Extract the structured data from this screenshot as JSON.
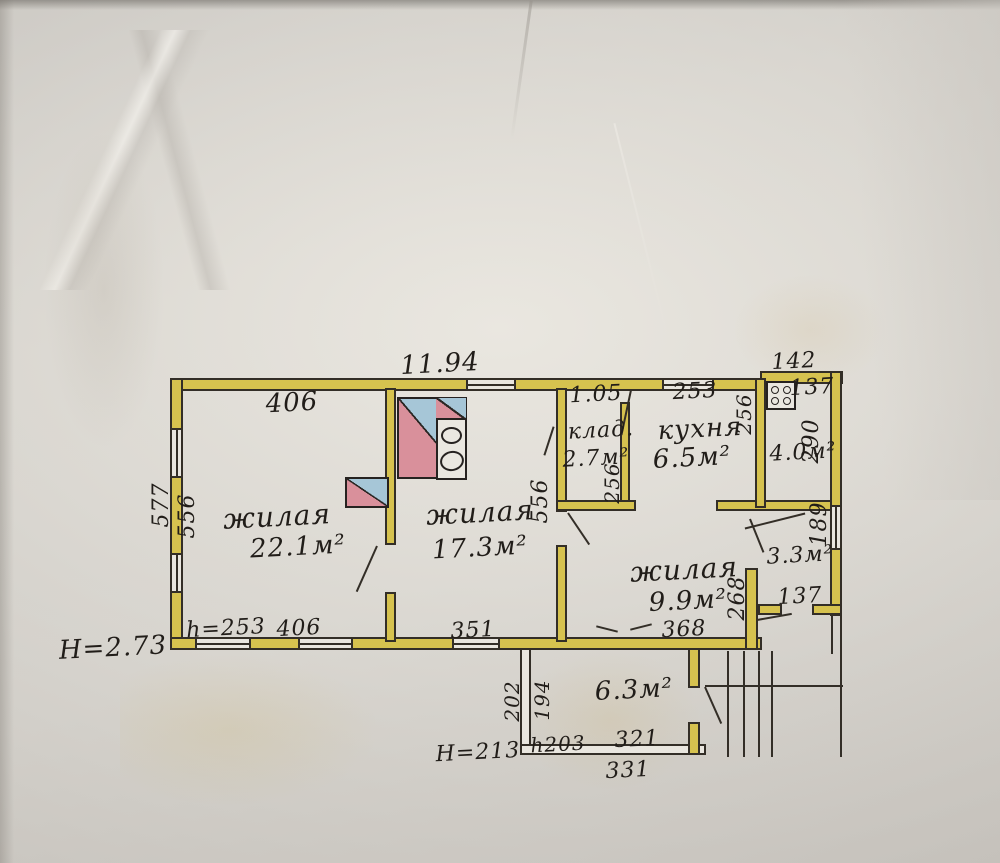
{
  "document": {
    "type": "hand-drawn floor plan (technical inventory plan)",
    "language": "Russian"
  },
  "colors": {
    "paper": "#d3cfca",
    "wall_fill": "#d6c24f",
    "ink": "#2b2724",
    "stove_blue": "#a6c6d7",
    "stove_red": "#d9909b"
  },
  "rooms": {
    "living1": {
      "name": "жилая",
      "area": "22.1м²"
    },
    "living2": {
      "name": "жилая",
      "area": "17.3м²"
    },
    "living3": {
      "name": "жилая",
      "area": "9.9м²"
    },
    "storage": {
      "name": "клад.",
      "area": "2.7м²"
    },
    "kitchen": {
      "name": "кухня",
      "area": "6.5м²"
    },
    "room40": {
      "area": "4.0м²"
    },
    "room33": {
      "area": "3.3м²"
    },
    "veranda": {
      "area": "6.3м²"
    }
  },
  "dims": {
    "top_total": "11.94",
    "top_left_room": "406",
    "storage_top": "1.05",
    "kitchen_top": "253",
    "wing_top": "142",
    "wing_stove": "137",
    "wing_right": "290",
    "kitchen_right": "256",
    "storage_right": "256",
    "left_outer": "577",
    "left_inner": "556",
    "mid_wall": "556",
    "room33_window": "189",
    "room33_bottom": "137",
    "passage_height": "268",
    "bottom_h": "h=253",
    "bottom_left": "406",
    "bottom_mid": "351",
    "bottom_right": "368",
    "main_height": "H=2.73",
    "veranda_left_outer": "202",
    "veranda_left_inner": "194",
    "veranda_h": "h203",
    "veranda_bottom_inner": "321",
    "veranda_bottom_outer": "331",
    "veranda_height": "H=213"
  },
  "icons": {
    "stove_big": "masonry-stove-with-two-burners",
    "stove_small": "masonry-stove",
    "gas_stove": "four-burner-stove",
    "stairs": "entrance-steps"
  }
}
